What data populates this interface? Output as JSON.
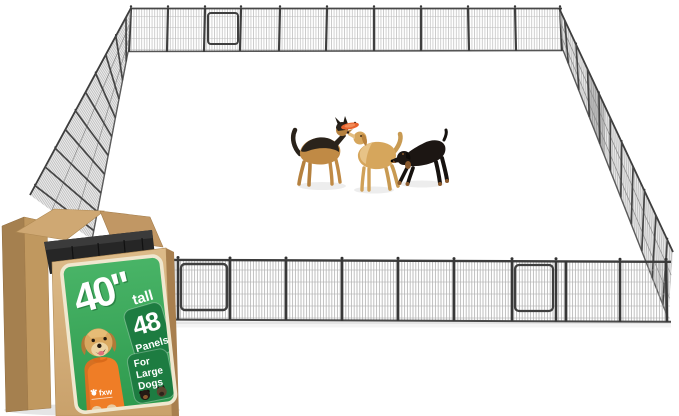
{
  "box_label": {
    "height_value": "40\"",
    "height_unit": "tall",
    "panel_count": "48",
    "panel_word": "Panels",
    "audience_line1": "For",
    "audience_line2": "Large",
    "audience_line3": "Dogs",
    "brand": "fxw"
  },
  "illustrations": {
    "pen": "black-wire-playpen-rectangle-with-gates",
    "dogs_in_pen": [
      "german-shepherd",
      "golden-retriever",
      "rottweiler"
    ],
    "toy": "orange-frisbee",
    "box": "cardboard-box-with-stacked-black-panels",
    "label_dog": "golden-retriever-in-orange-shirt",
    "label_dog_heads": [
      "rottweiler-head",
      "german-shepherd-head"
    ]
  },
  "colors": {
    "background": "#ffffff",
    "label_green": "#3aa65b",
    "badge_green": "#1d7c41",
    "label_border": "#f0e7cf",
    "cardboard": "#d2ab75",
    "shirt_orange": "#ef7d26",
    "frisbee_orange": "#e8622d",
    "metal_dark": "#262626",
    "mesh_gray": "#9e9e9e"
  }
}
